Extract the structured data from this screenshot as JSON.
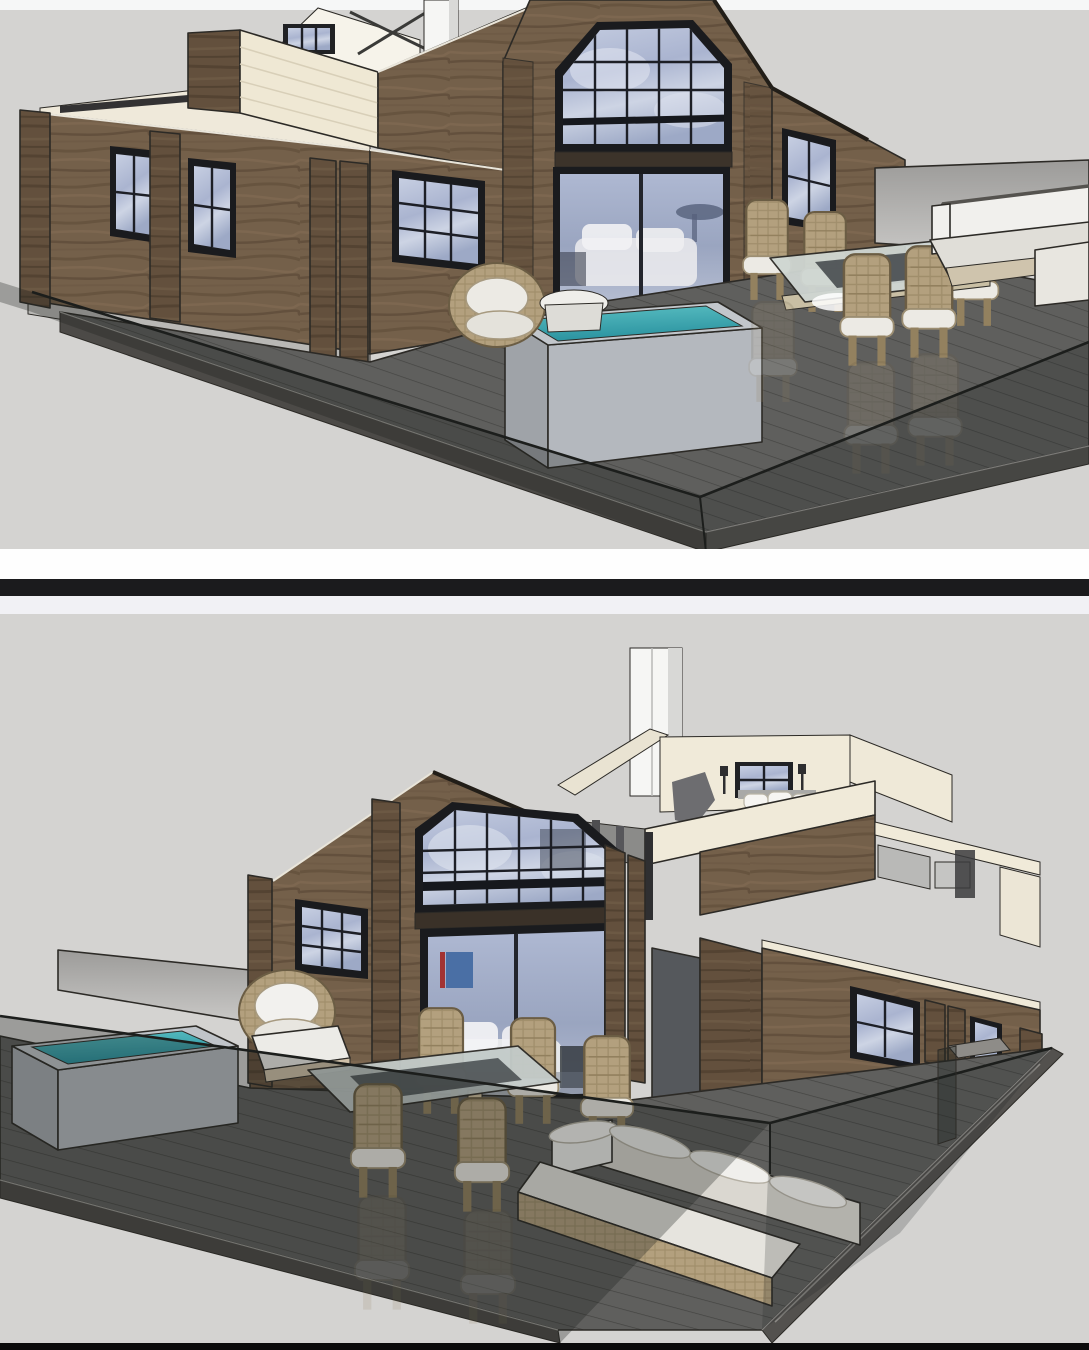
{
  "page": {
    "kind": "image-collage",
    "description": "Two stacked 3D cut-away architectural renderings of a modern timber cabin with a large deck, separated by a black horizontal divider bar."
  },
  "panels": {
    "top": {
      "id": "top-render",
      "description": "Cut-away rendering of a wooden cabin seen from the front-left: open-top rooms with cream interior walls, white chimney, large black-framed gable window over sliding glass doors, side windows, gray privacy wall, and a dark timber deck behind a glass railing holding a square hot tub with teal water, a round wicker lounge chair with side table, a glass-topped wicker dining set and a white L-shaped outdoor sofa."
    },
    "bottom": {
      "id": "bottom-render",
      "description": "Mirrored rendering of the same cabin seen from the opposite corner: white chimney over a cut-open loft bedroom with pillows and a window, large gable window above sliding doors with a white sofa and blue artwork inside, side wing with windows, and a deck with hot tub, barrel chair with ottoman, glass dining table with wicker chairs and an L-shaped sofa, all wrapped by a frameless glass railing."
    }
  },
  "divider": {
    "bands": [
      "white",
      "black",
      "light"
    ]
  },
  "colors": {
    "background": "#d4d3d1",
    "top_strip": "#f6f7f7",
    "divider_white": "#fefefe",
    "divider_black": "#1b1b1d",
    "divider_light": "#f1f1f5",
    "bottom_bar": "#0b0b0b",
    "wood": "#74604a",
    "wood_dark": "#5a4836",
    "wood_light": "#8a745c",
    "frame": "#1a1b1e",
    "glass": "#b3bcd4",
    "glass_light": "#d8dde9",
    "interior_cream": "#f0ead9",
    "cream_wall": "#efe8d4",
    "deck": "#5f5f5d",
    "deck_fascia": "#4c4a47",
    "glass_rail_tint": "rgba(26,30,28,0.30)",
    "water_teal": "#3aabb0",
    "water_deep": "#2b93a0",
    "wicker": "#b3a07e",
    "cushion": "#eceae4",
    "privacy_wall": "#b5b4b2",
    "chimney": "#f6f6f4",
    "outline": "#2c2a26"
  }
}
